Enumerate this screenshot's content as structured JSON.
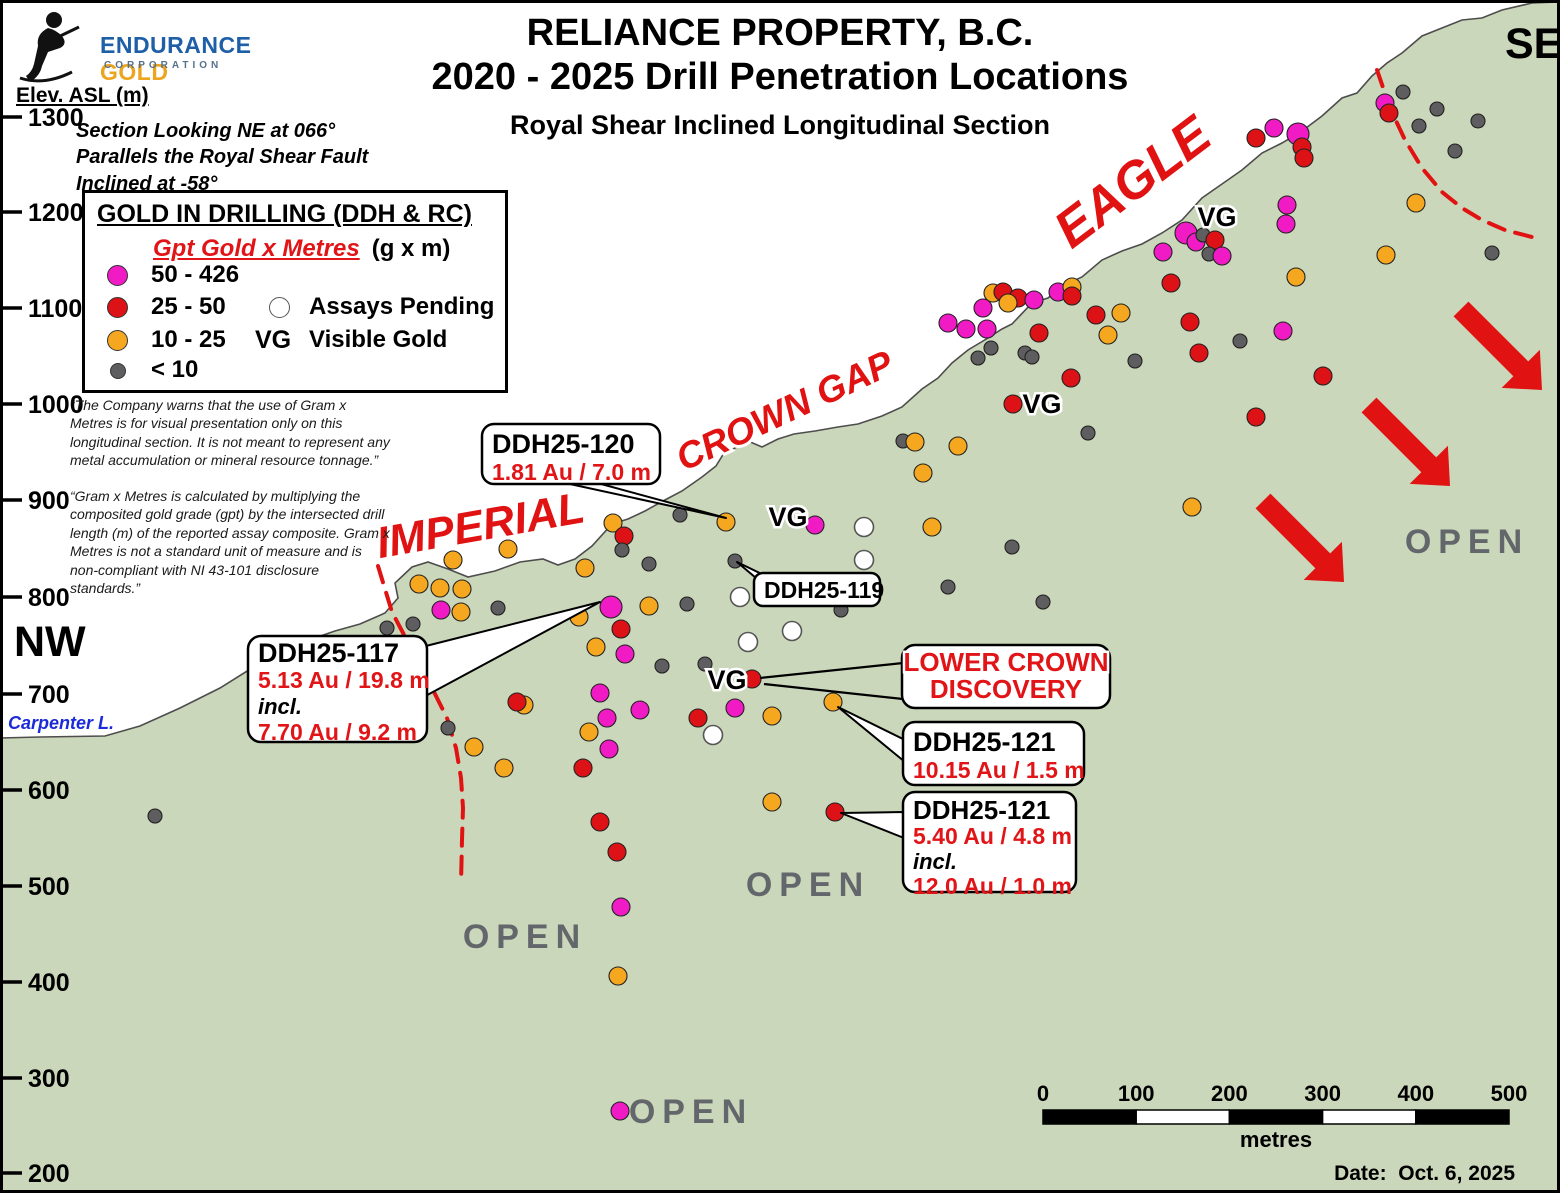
{
  "logo": {
    "endurance": "ENDURANCE",
    "gold": "GOLD",
    "corporation": "CORPORATION",
    "endurance_color": "#1E5FA8",
    "gold_color": "#EBA51F"
  },
  "header": {
    "title1": "RELIANCE PROPERTY, B.C.",
    "title2": "2020 - 2025 Drill Penetration Locations",
    "subtitle": "Royal Shear Inclined Longitudinal Section"
  },
  "axis": {
    "title": "Elev. ASL (m)"
  },
  "notes": {
    "section": "Section Looking NE at 066°\nParallels the Royal Shear Fault\nInclined at -58°",
    "disclaimer1": "“The Company warns that the use of Gram x Metres is for visual presentation only on this longitudinal section. It is not meant to represent any metal accumulation or mineral resource tonnage.”",
    "disclaimer2": "“Gram x Metres is calculated by multiplying the composited gold grade (gpt) by the intersected drill length (m) of the reported assay composite. Gram x Metres is not a standard unit of measure and is non-compliant with NI 43-101 disclosure standards.”"
  },
  "legend": {
    "title": "GOLD IN DRILLING (DDH & RC)",
    "subtitle": "Gpt Gold x Metres",
    "units": "(g x m)",
    "items": [
      {
        "label": "50 - 426",
        "color": "#F01BC4"
      },
      {
        "label": "25 - 50",
        "color": "#DC1216"
      },
      {
        "label": "10 - 25",
        "color": "#F4A71F"
      },
      {
        "label": "< 10",
        "color": "#5E5E60"
      }
    ],
    "pending_label": "Assays Pending",
    "vg_symbol": "VG",
    "vg_label": "Visible Gold"
  },
  "labels": {
    "nw": "NW",
    "se": "SE",
    "carpenter": "Carpenter L.",
    "date": "Date:  Oct. 6, 2025",
    "zones": [
      {
        "text": "IMPERIAL",
        "x": 483,
        "y": 540,
        "rot": -10,
        "fs": 44
      },
      {
        "text": "CROWN GAP",
        "x": 790,
        "y": 422,
        "rot": -25,
        "fs": 37
      },
      {
        "text": "EAGLE",
        "x": 1143,
        "y": 196,
        "rot": -37,
        "fs": 52
      }
    ],
    "open": [
      {
        "text": "OPEN",
        "x": 1467,
        "y": 553
      },
      {
        "text": "OPEN",
        "x": 808,
        "y": 896
      },
      {
        "text": "OPEN",
        "x": 525,
        "y": 948
      },
      {
        "text": "OPEN",
        "x": 691,
        "y": 1123
      }
    ],
    "vg_markers": [
      {
        "text": "VG",
        "x": 1217,
        "y": 226
      },
      {
        "text": "VG",
        "x": 1042,
        "y": 413
      },
      {
        "text": "VG",
        "x": 788,
        "y": 526
      },
      {
        "text": "VG",
        "x": 727,
        "y": 689
      }
    ]
  },
  "chart_data": {
    "type": "scatter",
    "title": "2020 - 2025 Drill Penetration Locations — Royal Shear Inclined Longitudinal Section",
    "ylabel": "Elev. ASL (m)",
    "y_ticks": [
      1300,
      1200,
      1100,
      1000,
      900,
      800,
      700,
      600,
      500,
      400,
      300,
      200
    ],
    "classes": {
      "m": "50 - 426 g x m",
      "r": "25 - 50 g x m",
      "o": "10 - 25 g x m",
      "g": "< 10 g x m",
      "w": "Assays Pending"
    },
    "points": [
      [
        508,
        549,
        "o"
      ],
      [
        453,
        560,
        "o"
      ],
      [
        585,
        568,
        "o"
      ],
      [
        649,
        564,
        "g"
      ],
      [
        613,
        523,
        "o"
      ],
      [
        624,
        536,
        "r"
      ],
      [
        622,
        550,
        "g"
      ],
      [
        680,
        515,
        "g"
      ],
      [
        419,
        584,
        "o"
      ],
      [
        440,
        588,
        "o"
      ],
      [
        462,
        589,
        "o"
      ],
      [
        441,
        610,
        "m"
      ],
      [
        461,
        612,
        "o"
      ],
      [
        498,
        608,
        "g"
      ],
      [
        387,
        628,
        "g"
      ],
      [
        413,
        624,
        "g"
      ],
      [
        611,
        607,
        "m",
        11
      ],
      [
        579,
        617,
        "o"
      ],
      [
        649,
        606,
        "o"
      ],
      [
        687,
        604,
        "g"
      ],
      [
        621,
        629,
        "r"
      ],
      [
        596,
        647,
        "o"
      ],
      [
        625,
        654,
        "m"
      ],
      [
        662,
        666,
        "g"
      ],
      [
        705,
        664,
        "g"
      ],
      [
        600,
        693,
        "m"
      ],
      [
        524,
        705,
        "o"
      ],
      [
        517,
        702,
        "r"
      ],
      [
        640,
        710,
        "m"
      ],
      [
        607,
        718,
        "m"
      ],
      [
        589,
        732,
        "o"
      ],
      [
        448,
        728,
        "g"
      ],
      [
        698,
        718,
        "r"
      ],
      [
        713,
        735,
        "w"
      ],
      [
        474,
        747,
        "o"
      ],
      [
        609,
        749,
        "m"
      ],
      [
        504,
        768,
        "o"
      ],
      [
        583,
        768,
        "r"
      ],
      [
        600,
        822,
        "r"
      ],
      [
        617,
        852,
        "r"
      ],
      [
        621,
        907,
        "m"
      ],
      [
        618,
        976,
        "o"
      ],
      [
        620,
        1111,
        "m"
      ],
      [
        155,
        816,
        "g"
      ],
      [
        726,
        522,
        "o"
      ],
      [
        815,
        525,
        "m"
      ],
      [
        864,
        527,
        "w"
      ],
      [
        932,
        527,
        "o"
      ],
      [
        864,
        560,
        "w"
      ],
      [
        735,
        561,
        "g"
      ],
      [
        740,
        597,
        "w"
      ],
      [
        841,
        610,
        "g"
      ],
      [
        792,
        631,
        "w"
      ],
      [
        948,
        587,
        "g"
      ],
      [
        748,
        642,
        "w"
      ],
      [
        752,
        679,
        "r"
      ],
      [
        735,
        708,
        "m"
      ],
      [
        772,
        716,
        "o"
      ],
      [
        833,
        702,
        "o"
      ],
      [
        772,
        802,
        "o"
      ],
      [
        835,
        812,
        "r"
      ],
      [
        903,
        441,
        "g"
      ],
      [
        915,
        442,
        "o"
      ],
      [
        958,
        446,
        "o"
      ],
      [
        923,
        473,
        "o"
      ],
      [
        1088,
        433,
        "g"
      ],
      [
        1012,
        547,
        "g"
      ],
      [
        1043,
        602,
        "g"
      ],
      [
        1192,
        507,
        "o"
      ],
      [
        993,
        293,
        "o"
      ],
      [
        1003,
        292,
        "r"
      ],
      [
        1018,
        298,
        "r"
      ],
      [
        1034,
        300,
        "m"
      ],
      [
        983,
        308,
        "m"
      ],
      [
        1008,
        303,
        "o"
      ],
      [
        948,
        323,
        "m"
      ],
      [
        966,
        329,
        "m"
      ],
      [
        987,
        329,
        "m"
      ],
      [
        1058,
        292,
        "m"
      ],
      [
        1072,
        287,
        "o"
      ],
      [
        1072,
        296,
        "r"
      ],
      [
        1096,
        315,
        "r"
      ],
      [
        1121,
        313,
        "o"
      ],
      [
        1108,
        335,
        "o"
      ],
      [
        1039,
        333,
        "r"
      ],
      [
        991,
        348,
        "g"
      ],
      [
        978,
        358,
        "g"
      ],
      [
        1025,
        353,
        "g"
      ],
      [
        1032,
        357,
        "g"
      ],
      [
        1135,
        361,
        "g"
      ],
      [
        1171,
        283,
        "r"
      ],
      [
        1190,
        322,
        "r"
      ],
      [
        1199,
        353,
        "r"
      ],
      [
        1071,
        378,
        "r"
      ],
      [
        1013,
        404,
        "r"
      ],
      [
        1186,
        233,
        "m",
        11
      ],
      [
        1196,
        242,
        "m"
      ],
      [
        1203,
        235,
        "g"
      ],
      [
        1215,
        240,
        "r"
      ],
      [
        1163,
        252,
        "m"
      ],
      [
        1209,
        254,
        "g"
      ],
      [
        1222,
        256,
        "m"
      ],
      [
        1287,
        205,
        "m"
      ],
      [
        1286,
        224,
        "m"
      ],
      [
        1283,
        331,
        "m"
      ],
      [
        1240,
        341,
        "g"
      ],
      [
        1323,
        376,
        "r"
      ],
      [
        1256,
        417,
        "r"
      ],
      [
        1296,
        277,
        "o"
      ],
      [
        1386,
        255,
        "o"
      ],
      [
        1416,
        203,
        "o"
      ],
      [
        1256,
        138,
        "r"
      ],
      [
        1274,
        128,
        "m"
      ],
      [
        1298,
        134,
        "m",
        11
      ],
      [
        1302,
        147,
        "r"
      ],
      [
        1304,
        158,
        "r"
      ],
      [
        1385,
        103,
        "m"
      ],
      [
        1389,
        113,
        "r"
      ],
      [
        1403,
        92,
        "g"
      ],
      [
        1437,
        109,
        "g"
      ],
      [
        1419,
        126,
        "g"
      ],
      [
        1478,
        121,
        "g"
      ],
      [
        1455,
        151,
        "g"
      ],
      [
        1492,
        253,
        "g"
      ]
    ]
  },
  "map": {
    "colors": {
      "m": "#F01BC4",
      "r": "#DC1216",
      "o": "#F4A71F",
      "g": "#5E5E60",
      "w": "#FFFFFF",
      "green": "#CBD7BA",
      "fault": "#E01212",
      "arrow": "#E01212",
      "red_text": "#E11417",
      "open_gray": "#63676B"
    },
    "class_names": {
      "m": "gold-50-426",
      "r": "gold-25-50",
      "o": "gold-10-25",
      "g": "gold-lt-10",
      "w": "assay-pending"
    },
    "dot_radius": {
      "m": 9,
      "r": 9,
      "o": 9,
      "g": 7,
      "w": 9.5
    },
    "surface_line": "0,738 40,737 105,736 140,726 180,708 220,688 260,663 300,643 335,631 360,624 385,613 398,598 395,583 412,567 428,562 448,569 468,577 495,571 520,562 543,559 558,565 575,559 592,546 612,524 628,519 645,511 663,501 682,491 702,477 716,466 724,453 735,448 748,441 762,447 778,439 794,434 815,431 838,427 858,424 882,416 902,407 922,389 938,378 952,363 968,350 988,338 1002,329 1012,324 1032,303 1048,298 1062,286 1082,277 1102,260 1122,251 1142,244 1162,233 1182,220 1202,198 1222,184 1242,170 1262,153 1282,143 1302,131 1322,116 1342,98 1357,93 1372,76 1387,63 1402,53 1422,36 1442,28 1462,20 1482,18 1502,10 1532,3 1558,2",
    "faults": [
      {
        "name": "imperial-fault",
        "points": "378,566 392,612 412,650 432,688 447,718 456,748 461,778 463,808 462,840 461,884"
      },
      {
        "name": "eagle-fault",
        "points": "1377,70 1390,108 1405,140 1422,168 1442,192 1462,208 1482,220 1505,230 1532,237"
      }
    ],
    "arrows": [
      {
        "tail": [
          1461,
          309
        ],
        "tip": [
          1542,
          390
        ]
      },
      {
        "tail": [
          1369,
          405
        ],
        "tip": [
          1450,
          486
        ]
      },
      {
        "tail": [
          1263,
          501
        ],
        "tip": [
          1344,
          582
        ]
      }
    ],
    "elev_ticks": [
      {
        "label": "1300",
        "y": 117
      },
      {
        "label": "1200",
        "y": 212
      },
      {
        "label": "1100",
        "y": 308
      },
      {
        "label": "1000",
        "y": 404
      },
      {
        "label": "900",
        "y": 500
      },
      {
        "label": "800",
        "y": 597
      },
      {
        "label": "700",
        "y": 694
      },
      {
        "label": "600",
        "y": 790
      },
      {
        "label": "500",
        "y": 886
      },
      {
        "label": "400",
        "y": 982
      },
      {
        "label": "300",
        "y": 1078
      },
      {
        "label": "200",
        "y": 1173
      }
    ],
    "callouts": [
      {
        "id": "callout-ddh25-117",
        "box": [
          248,
          636,
          179,
          106
        ],
        "rx": 13,
        "pad": 26,
        "lh": 26,
        "fs": 23,
        "wedge": [
          [
            418,
            648
          ],
          [
            600,
            602
          ],
          [
            418,
            700
          ]
        ],
        "lines": [
          {
            "t": "DDH25-117",
            "c": "k",
            "fs": 27
          },
          {
            "t": "5.13 Au / 19.8 m",
            "c": "r"
          },
          {
            "t": "incl.",
            "c": "k",
            "i": 1,
            "fs": 22
          },
          {
            "t": "7.70 Au / 9.2 m",
            "c": "r"
          }
        ]
      },
      {
        "id": "callout-ddh25-120",
        "box": [
          482,
          424,
          178,
          60
        ],
        "rx": 12,
        "pad": 29,
        "lh": 27,
        "fs": 23,
        "wedge": [
          [
            556,
            481
          ],
          [
            590,
            481
          ],
          [
            726,
            518
          ]
        ],
        "lines": [
          {
            "t": "DDH25-120",
            "c": "k",
            "fs": 27
          },
          {
            "t": "1.81 Au / 7.0 m",
            "c": "r"
          }
        ]
      },
      {
        "id": "callout-ddh25-119",
        "box": [
          754,
          573,
          126,
          33
        ],
        "rx": 9,
        "pad": 25,
        "lh": 24,
        "fs": 23,
        "wedge": [
          [
            756,
            578
          ],
          [
            774,
            580
          ],
          [
            737,
            562
          ]
        ],
        "lines": [
          {
            "t": "DDH25-119",
            "c": "k"
          }
        ]
      },
      {
        "id": "callout-lower-crown",
        "box": [
          902,
          645,
          208,
          63
        ],
        "rx": 13,
        "pad": 26,
        "lh": 27,
        "fs": 26,
        "align": "center",
        "halo": 1,
        "leaders": [
          [
            [
              903,
              663
            ],
            [
              760,
              678
            ]
          ],
          [
            [
              903,
              699
            ],
            [
              764,
              684
            ]
          ]
        ],
        "lines": [
          {
            "t": "LOWER CROWN",
            "c": "r"
          },
          {
            "t": "DISCOVERY",
            "c": "r"
          }
        ]
      },
      {
        "id": "callout-ddh25-121a",
        "box": [
          903,
          722,
          181,
          63
        ],
        "rx": 12,
        "pad": 29,
        "lh": 27,
        "fs": 23,
        "wedge": [
          [
            905,
            740
          ],
          [
            905,
            762
          ],
          [
            838,
            707
          ]
        ],
        "lines": [
          {
            "t": "DDH25-121",
            "c": "k",
            "fs": 27
          },
          {
            "t": "10.15 Au / 1.5 m",
            "c": "r"
          }
        ]
      },
      {
        "id": "callout-ddh25-121b",
        "box": [
          903,
          792,
          173,
          100
        ],
        "rx": 12,
        "pad": 27,
        "lh": 25,
        "fs": 23,
        "wedge": [
          [
            904,
            812
          ],
          [
            904,
            838
          ],
          [
            841,
            813
          ]
        ],
        "lines": [
          {
            "t": "DDH25-121",
            "c": "k",
            "fs": 26
          },
          {
            "t": "5.40 Au / 4.8 m",
            "c": "r"
          },
          {
            "t": "incl.",
            "c": "k",
            "i": 1,
            "fs": 22
          },
          {
            "t": "12.0 Au / 1.0 m",
            "c": "r"
          }
        ]
      }
    ],
    "scalebar": {
      "x0": 1043,
      "x1": 1509,
      "bar_y": 1110,
      "bar_h": 14,
      "labels": [
        "0",
        "100",
        "200",
        "300",
        "400",
        "500"
      ],
      "label_y": 1101,
      "units": "metres",
      "units_y": 1147
    }
  }
}
